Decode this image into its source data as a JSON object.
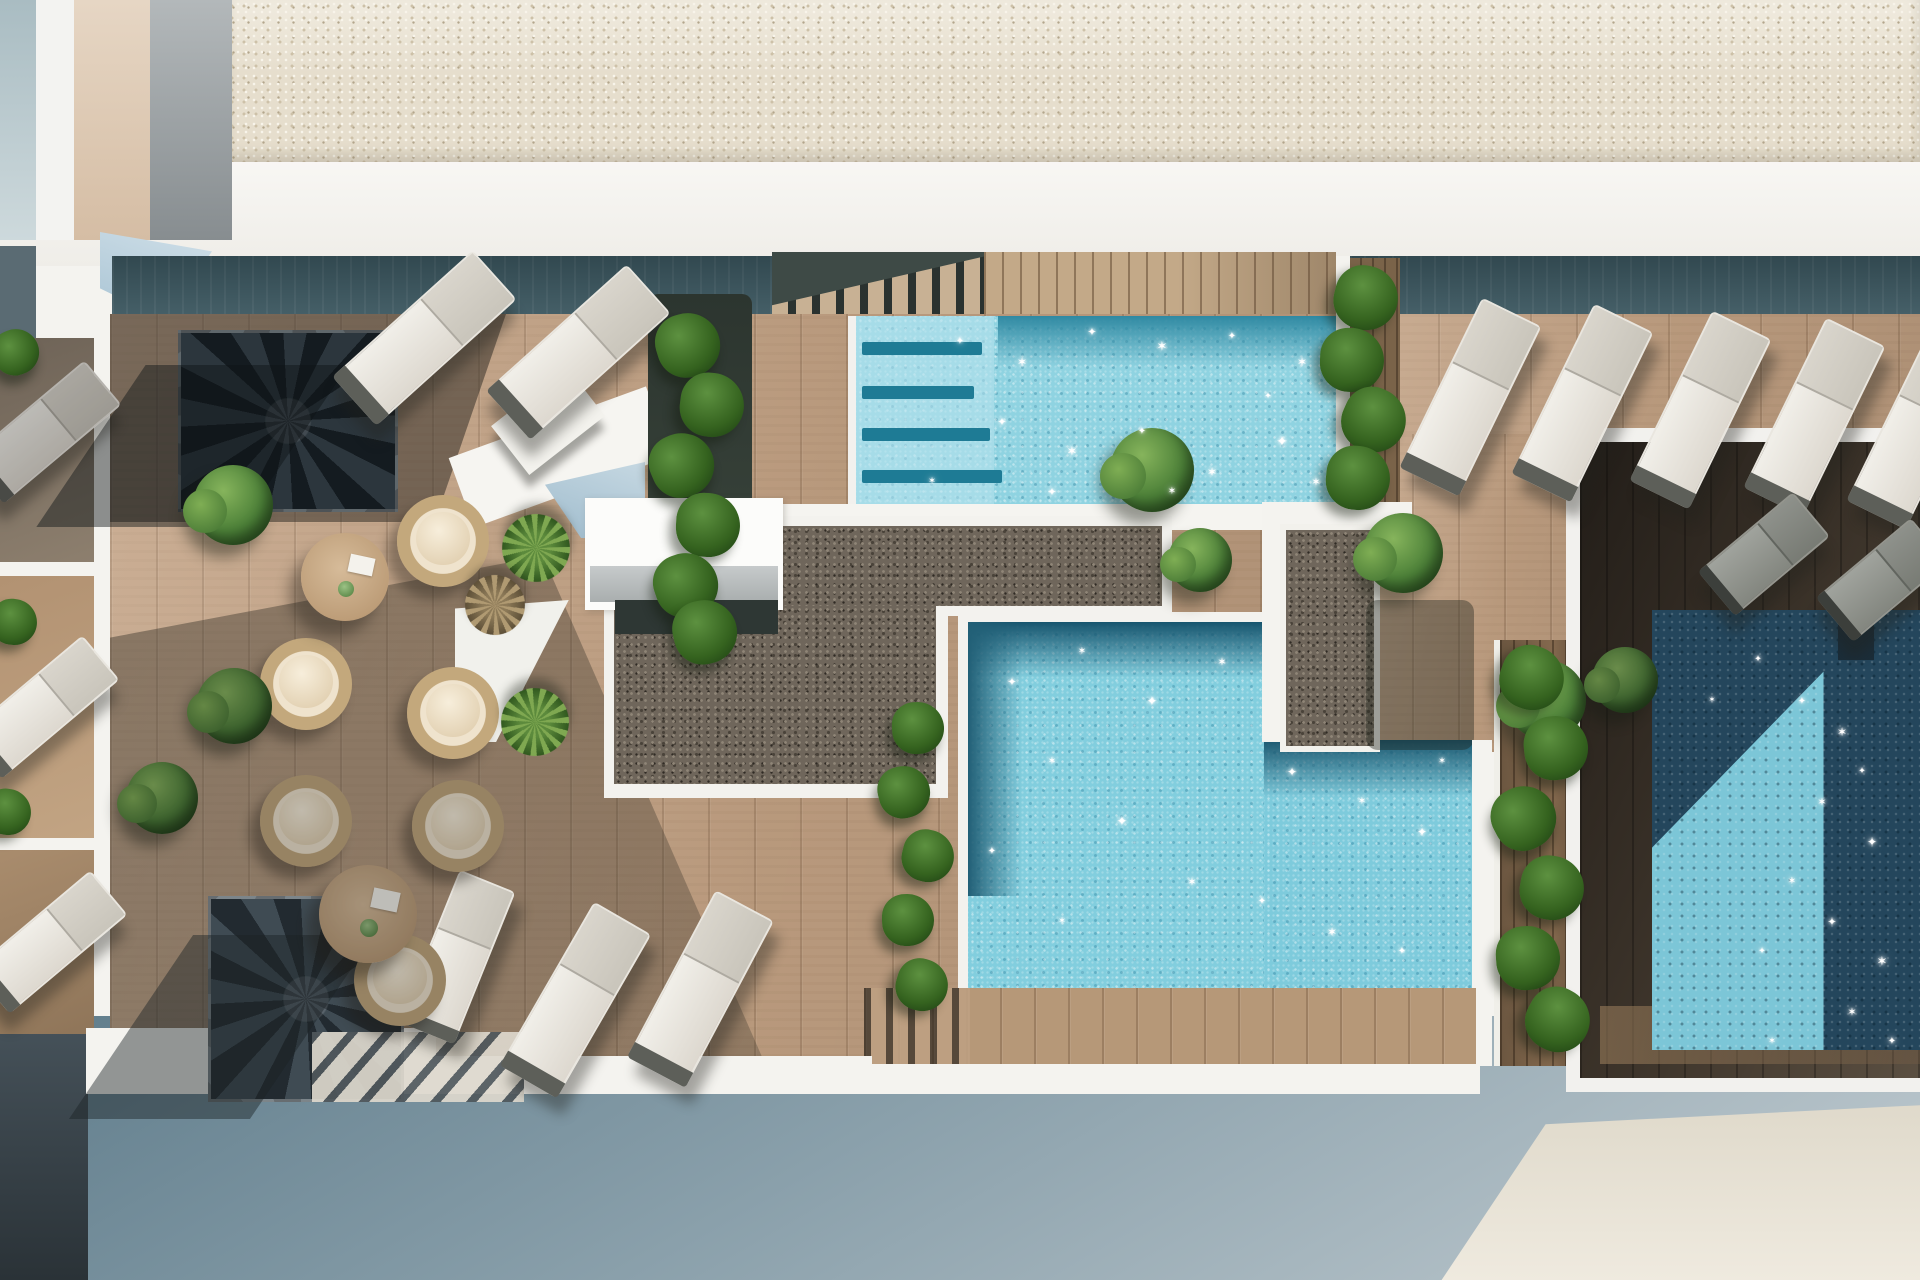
{
  "meta": {
    "type": "3d-architectural-render",
    "subject": "top-down view of a residential rooftop pool terrace with wooden decks, three swimming pools, gravel roofs, lounge furniture and planting"
  },
  "palette": {
    "deck": "#c2a183",
    "deckShadow": "#6e6154",
    "gravelLight": "#e6decd",
    "gravelDark": "#6f665b",
    "poolLight": "#8fd3e1",
    "poolMid": "#82cede",
    "poolDarkBand": "#1d5a72",
    "poolNight": "#24465c",
    "poolNightLight": "#7cc6d7",
    "tealShadow": "#3c5861",
    "white": "#f4f3ef",
    "slateFacade": "#5f7c8b",
    "creamFacade": "#e7e1d2",
    "plantGreen": "#4c8038",
    "wicker": "#c3a87c",
    "cushion": "#efe3cd"
  },
  "inventory": {
    "swimming_pools": 3,
    "sun_loungers_white": 13,
    "sun_loungers_gray": 2,
    "wicker_lounge_chairs": 6,
    "round_coffee_tables": 2,
    "spiral_staircases": 2,
    "shrubs": 8,
    "yucca_plants": 2,
    "dry_palm_plants": 1,
    "vine_planter_columns": 4,
    "water_sparkle_highlights": 46
  },
  "furniture": {
    "loungers_white": [
      [
        422,
        336,
        -42
      ],
      [
        576,
        350,
        -42
      ],
      [
        1468,
        395,
        -64
      ],
      [
        1580,
        401,
        -64
      ],
      [
        1698,
        408,
        -64
      ],
      [
        1812,
        415,
        -64
      ],
      [
        1915,
        428,
        -64
      ],
      [
        455,
        955,
        -68,
        160,
        56
      ],
      [
        573,
        998,
        -60
      ],
      [
        698,
        987,
        -62
      ],
      [
        42,
        430,
        -40,
        150,
        54,
        1
      ],
      [
        40,
        705,
        -40,
        150,
        54
      ],
      [
        48,
        940,
        -40,
        150,
        54
      ]
    ],
    "loungers_gray": [
      [
        1762,
        552,
        -40,
        120,
        54
      ],
      [
        1880,
        578,
        -40,
        120,
        54
      ]
    ],
    "chairs": [
      [
        443,
        541
      ],
      [
        306,
        684
      ],
      [
        453,
        713
      ],
      [
        306,
        821,
        1
      ],
      [
        458,
        826,
        1
      ],
      [
        400,
        980,
        1
      ]
    ],
    "tables": [
      [
        345,
        577,
        88
      ],
      [
        368,
        914,
        98,
        1
      ]
    ],
    "bushes": [
      [
        233,
        505,
        80
      ],
      [
        234,
        706,
        76,
        1
      ],
      [
        162,
        798,
        72,
        1
      ],
      [
        1152,
        470,
        84
      ],
      [
        1200,
        560,
        64
      ],
      [
        1403,
        553,
        80
      ],
      [
        1546,
        700,
        80
      ],
      [
        1625,
        680,
        66,
        1
      ]
    ],
    "yuccas": [
      [
        536,
        548,
        68
      ],
      [
        535,
        722,
        68
      ]
    ],
    "palms": [
      [
        495,
        605,
        60
      ]
    ],
    "vines": [
      [
        688,
        345
      ],
      [
        712,
        405
      ],
      [
        682,
        465
      ],
      [
        708,
        525
      ],
      [
        686,
        585
      ],
      [
        705,
        632
      ],
      [
        1366,
        298
      ],
      [
        1352,
        360
      ],
      [
        1374,
        420
      ],
      [
        1358,
        478
      ],
      [
        1532,
        678
      ],
      [
        1556,
        748
      ],
      [
        1524,
        818
      ],
      [
        1552,
        888
      ],
      [
        1528,
        958
      ],
      [
        1558,
        1020
      ],
      [
        918,
        728,
        52
      ],
      [
        904,
        792,
        52
      ],
      [
        928,
        856,
        52
      ],
      [
        908,
        920,
        52
      ],
      [
        922,
        985,
        52
      ],
      [
        16,
        352,
        46
      ],
      [
        14,
        622,
        46
      ],
      [
        8,
        812,
        46
      ]
    ]
  },
  "sparkles": {
    "glyphs": [
      "✦",
      "✶"
    ],
    "points": [
      [
        960,
        342,
        10
      ],
      [
        1022,
        362,
        12
      ],
      [
        1092,
        332,
        11
      ],
      [
        1162,
        347,
        13
      ],
      [
        1232,
        337,
        10
      ],
      [
        1302,
        362,
        12
      ],
      [
        1002,
        422,
        11
      ],
      [
        1072,
        452,
        13
      ],
      [
        1142,
        432,
        10
      ],
      [
        1212,
        472,
        12
      ],
      [
        1282,
        442,
        14
      ],
      [
        932,
        482,
        9
      ],
      [
        1052,
        492,
        11
      ],
      [
        1172,
        492,
        10
      ],
      [
        1268,
        397,
        9
      ],
      [
        1316,
        482,
        11
      ],
      [
        1012,
        682,
        11
      ],
      [
        1082,
        652,
        10
      ],
      [
        1152,
        702,
        13
      ],
      [
        1222,
        662,
        11
      ],
      [
        1292,
        772,
        12
      ],
      [
        1362,
        802,
        10
      ],
      [
        1422,
        832,
        12
      ],
      [
        1052,
        762,
        10
      ],
      [
        1122,
        822,
        13
      ],
      [
        1192,
        882,
        11
      ],
      [
        1262,
        902,
        10
      ],
      [
        1332,
        932,
        12
      ],
      [
        1402,
        952,
        10
      ],
      [
        1062,
        922,
        9
      ],
      [
        992,
        852,
        10
      ],
      [
        1442,
        762,
        9
      ],
      [
        1802,
        702,
        10
      ],
      [
        1842,
        732,
        12
      ],
      [
        1862,
        772,
        9
      ],
      [
        1822,
        802,
        11
      ],
      [
        1872,
        842,
        12
      ],
      [
        1792,
        882,
        10
      ],
      [
        1832,
        922,
        11
      ],
      [
        1882,
        962,
        13
      ],
      [
        1762,
        952,
        9
      ],
      [
        1852,
        1012,
        11
      ],
      [
        1892,
        1042,
        10
      ],
      [
        1772,
        1042,
        9
      ],
      [
        1758,
        660,
        9
      ],
      [
        1712,
        700,
        8
      ]
    ]
  }
}
